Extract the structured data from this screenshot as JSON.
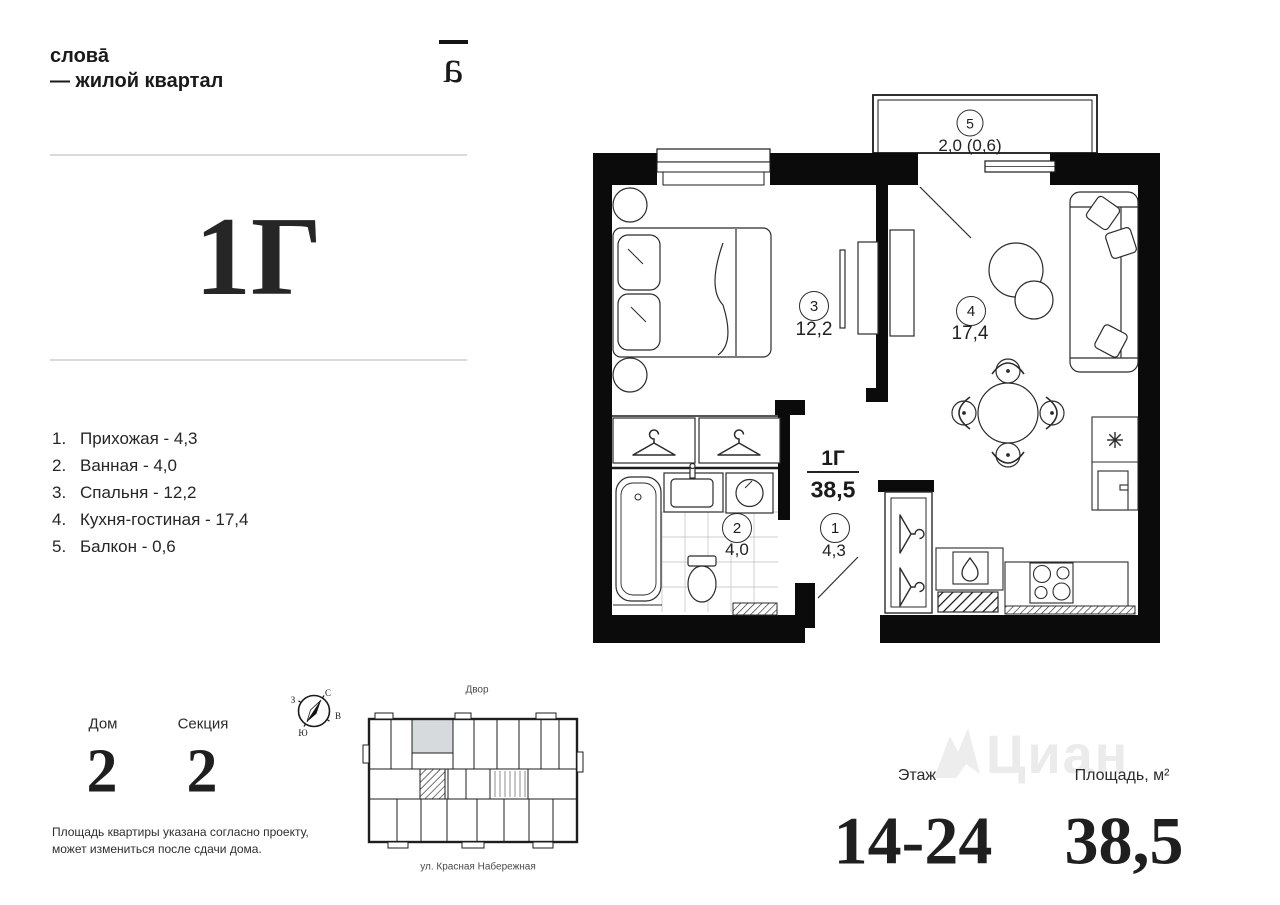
{
  "brand": {
    "name_line1": "слова̄",
    "name_line2": "— жилой квартал",
    "mark_glyph": "a"
  },
  "apartment": {
    "type": "1Г",
    "area": "38,5"
  },
  "room_list": {
    "items": [
      {
        "num": "1.",
        "label": "Прихожая - 4,3"
      },
      {
        "num": "2.",
        "label": "Ванная - 4,0"
      },
      {
        "num": "3.",
        "label": "Спальня - 12,2"
      },
      {
        "num": "4.",
        "label": "Кухня-гостиная - 17,4"
      },
      {
        "num": "5.",
        "label": "Балкон - 0,6"
      }
    ]
  },
  "plan": {
    "type_label": "1Г",
    "total_area": "38,5",
    "rooms": [
      {
        "num": "1",
        "area": "4,3"
      },
      {
        "num": "2",
        "area": "4,0"
      },
      {
        "num": "3",
        "area": "12,2"
      },
      {
        "num": "4",
        "area": "17,4"
      },
      {
        "num": "5",
        "area": "2,0 (0,6)"
      }
    ]
  },
  "info": {
    "house_label": "Дом",
    "house_value": "2",
    "section_label": "Секция",
    "section_value": "2",
    "floor_label": "Этаж",
    "floor_value": "14-24",
    "area_label": "Площадь, м²",
    "area_value": "38,5",
    "disclaimer": [
      "Площадь квартиры указана согласно проекту,",
      "может измениться после сдачи дома."
    ]
  },
  "site_plan": {
    "yard_label": "Двор",
    "street_label": "ул. Красная Набережная"
  },
  "compass": {
    "north": "С",
    "east": "В",
    "south": "Ю",
    "west": "З"
  },
  "watermark": {
    "text": "Циан"
  },
  "colors": {
    "ink": "#1a1a1a",
    "rule": "#dadada",
    "highlight": "#d7dadc",
    "watermark": "#ebebeb"
  }
}
